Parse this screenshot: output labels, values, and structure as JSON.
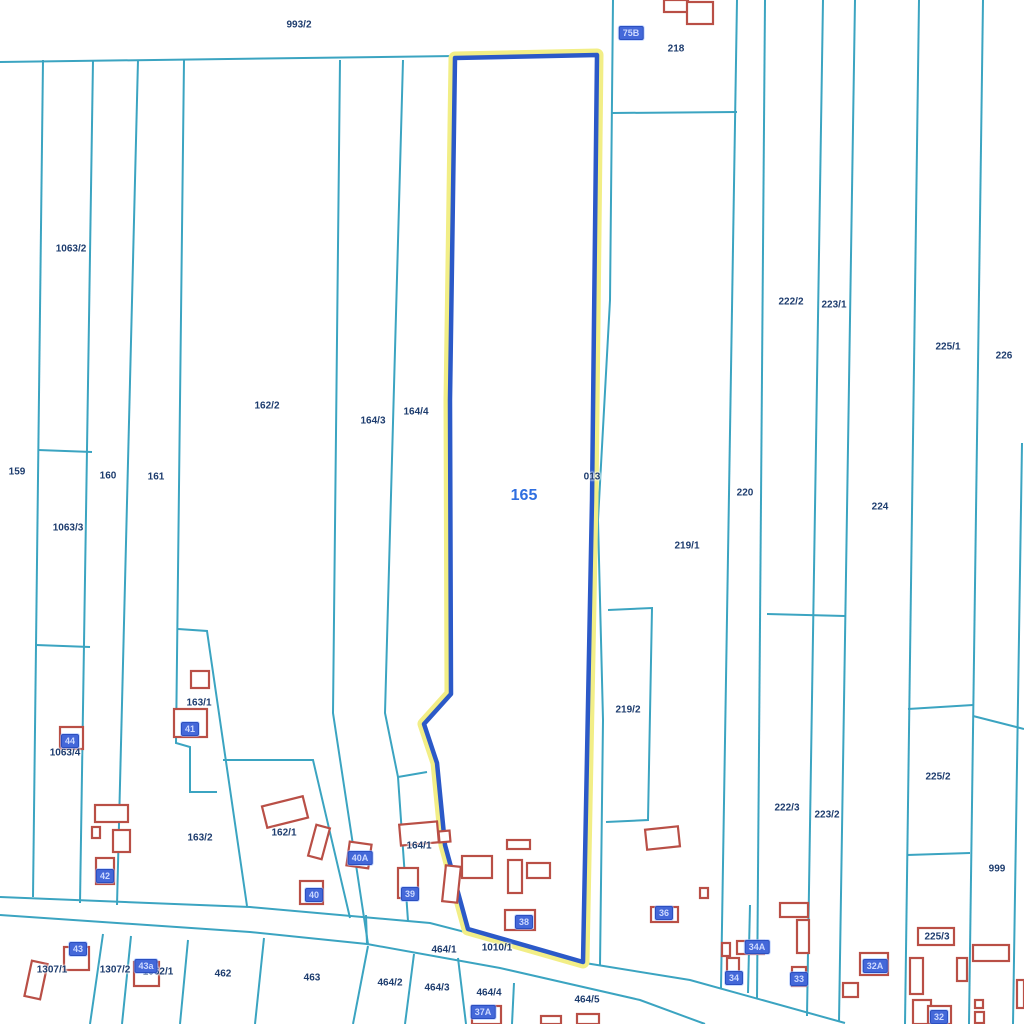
{
  "map": {
    "selected_parcel_id": "165",
    "colors": {
      "boundary_line": "#3BA4C1",
      "parcel_text": "#1d3c6e",
      "selected_text": "#2f6fe0",
      "building_stroke": "#b94f46",
      "building_label_bg": "#4468d9",
      "building_label_text": "#cdd9ff",
      "highlight_stroke": "#2b59c8",
      "highlight_halo": "#f2ee86"
    },
    "highlight_polygon": "455,58 597,55 592,500 583,962 468,929 445,845 437,763 424,724 451,694 450,400",
    "boundary_lines": [
      "0,62 455,56",
      "43,60 33,897",
      "93,60 80,903",
      "138,60 117,905",
      "184,60 176,743 190,747 190,792 217,792",
      "38,450 92,452",
      "36,645 90,647",
      "340,60 333,713 368,944",
      "403,60 385,713 398,777 408,921",
      "398,777 427,772",
      "178,629 207,631 247,906",
      "223,760 313,760 350,918",
      "0,897 250,907 430,923 585,963 690,980 845,1023",
      "0,915 250,932 367,944 500,968 640,1000 705,1024",
      "366,915 367,944",
      "613,0 610,300 598,520 603,720 600,966",
      "612,113 737,112",
      "737,0 721,988",
      "765,0 757,999",
      "750,905 748,993",
      "823,0 807,1016",
      "855,0 839,1022",
      "919,0 905,1024",
      "983,0 969,1024",
      "1022,443 1013,1024",
      "767,614 845,616",
      "908,709 973,705",
      "973,716 1024,729",
      "907,855 970,853",
      "608,610 652,608 648,820 606,822",
      "103,934 90,1024",
      "131,936 122,1024",
      "188,940 180,1024",
      "264,938 255,1024",
      "368,946 353,1024",
      "414,954 405,1024",
      "458,958 466,1024",
      "514,983 512,1024"
    ],
    "parcel_labels": [
      {
        "text": "993/2",
        "x": 299,
        "y": 25
      },
      {
        "text": "218",
        "x": 676,
        "y": 49
      },
      {
        "text": "1063/2",
        "x": 71,
        "y": 249
      },
      {
        "text": "222/2",
        "x": 791,
        "y": 302
      },
      {
        "text": "223/1",
        "x": 834,
        "y": 305
      },
      {
        "text": "225/1",
        "x": 948,
        "y": 347
      },
      {
        "text": "226",
        "x": 1004,
        "y": 356
      },
      {
        "text": "162/2",
        "x": 267,
        "y": 406
      },
      {
        "text": "164/4",
        "x": 416,
        "y": 412
      },
      {
        "text": "164/3",
        "x": 373,
        "y": 421
      },
      {
        "text": "159",
        "x": 17,
        "y": 472
      },
      {
        "text": "160",
        "x": 108,
        "y": 476
      },
      {
        "text": "161",
        "x": 156,
        "y": 477
      },
      {
        "text": "013",
        "x": 592,
        "y": 477
      },
      {
        "text": "220",
        "x": 745,
        "y": 493
      },
      {
        "text": "224",
        "x": 880,
        "y": 507
      },
      {
        "text": "1063/3",
        "x": 68,
        "y": 528
      },
      {
        "text": "219/1",
        "x": 687,
        "y": 546
      },
      {
        "text": "163/1",
        "x": 199,
        "y": 703
      },
      {
        "text": "219/2",
        "x": 628,
        "y": 710
      },
      {
        "text": "1063/4",
        "x": 65,
        "y": 753
      },
      {
        "text": "225/2",
        "x": 938,
        "y": 777
      },
      {
        "text": "222/3",
        "x": 787,
        "y": 808
      },
      {
        "text": "223/2",
        "x": 827,
        "y": 815
      },
      {
        "text": "162/1",
        "x": 284,
        "y": 833
      },
      {
        "text": "163/2",
        "x": 200,
        "y": 838
      },
      {
        "text": "164/1",
        "x": 419,
        "y": 846
      },
      {
        "text": "999",
        "x": 997,
        "y": 869
      },
      {
        "text": "225/3",
        "x": 937,
        "y": 937
      },
      {
        "text": "464/1",
        "x": 444,
        "y": 950
      },
      {
        "text": "1010/1",
        "x": 497,
        "y": 948
      },
      {
        "text": "1307/1",
        "x": 52,
        "y": 970
      },
      {
        "text": "1307/2",
        "x": 115,
        "y": 970
      },
      {
        "text": "1062/1",
        "x": 158,
        "y": 972
      },
      {
        "text": "462",
        "x": 223,
        "y": 974
      },
      {
        "text": "463",
        "x": 312,
        "y": 978
      },
      {
        "text": "464/2",
        "x": 390,
        "y": 983
      },
      {
        "text": "464/3",
        "x": 437,
        "y": 988
      },
      {
        "text": "464/4",
        "x": 489,
        "y": 993
      },
      {
        "text": "464/5",
        "x": 587,
        "y": 1000
      }
    ],
    "selected_label": {
      "text": "165",
      "x": 524,
      "y": 496
    },
    "building_labels": [
      {
        "text": "75B",
        "x": 631,
        "y": 33
      },
      {
        "text": "41",
        "x": 190,
        "y": 729
      },
      {
        "text": "44",
        "x": 70,
        "y": 741
      },
      {
        "text": "40A",
        "x": 360,
        "y": 858
      },
      {
        "text": "42",
        "x": 105,
        "y": 876
      },
      {
        "text": "40",
        "x": 314,
        "y": 895
      },
      {
        "text": "39",
        "x": 410,
        "y": 894
      },
      {
        "text": "36",
        "x": 664,
        "y": 913
      },
      {
        "text": "38",
        "x": 524,
        "y": 922
      },
      {
        "text": "34A",
        "x": 757,
        "y": 947
      },
      {
        "text": "43",
        "x": 78,
        "y": 949
      },
      {
        "text": "43a",
        "x": 146,
        "y": 966
      },
      {
        "text": "32A",
        "x": 875,
        "y": 966
      },
      {
        "text": "34",
        "x": 734,
        "y": 978
      },
      {
        "text": "33",
        "x": 799,
        "y": 979
      },
      {
        "text": "37A",
        "x": 483,
        "y": 1012
      },
      {
        "text": "32",
        "x": 939,
        "y": 1017
      }
    ],
    "buildings": [
      {
        "x": 664,
        "y": 0,
        "w": 24,
        "h": 12,
        "rot": 0
      },
      {
        "x": 687,
        "y": 2,
        "w": 26,
        "h": 22,
        "rot": 0
      },
      {
        "x": 191,
        "y": 671,
        "w": 18,
        "h": 17,
        "rot": 0
      },
      {
        "x": 174,
        "y": 709,
        "w": 33,
        "h": 28,
        "rot": 0
      },
      {
        "x": 60,
        "y": 727,
        "w": 23,
        "h": 22,
        "rot": 0
      },
      {
        "x": 95,
        "y": 805,
        "w": 33,
        "h": 17,
        "rot": 0
      },
      {
        "x": 92,
        "y": 827,
        "w": 8,
        "h": 11,
        "rot": 0
      },
      {
        "x": 113,
        "y": 830,
        "w": 17,
        "h": 22,
        "rot": 0
      },
      {
        "x": 96,
        "y": 858,
        "w": 18,
        "h": 26,
        "rot": 0
      },
      {
        "x": 264,
        "y": 801,
        "w": 42,
        "h": 22,
        "rot": -14
      },
      {
        "x": 312,
        "y": 826,
        "w": 14,
        "h": 32,
        "rot": 15
      },
      {
        "x": 348,
        "y": 843,
        "w": 22,
        "h": 24,
        "rot": 8
      },
      {
        "x": 300,
        "y": 881,
        "w": 23,
        "h": 23,
        "rot": 0
      },
      {
        "x": 400,
        "y": 823,
        "w": 38,
        "h": 21,
        "rot": -5
      },
      {
        "x": 439,
        "y": 831,
        "w": 11,
        "h": 11,
        "rot": -5
      },
      {
        "x": 444,
        "y": 866,
        "w": 15,
        "h": 36,
        "rot": 6
      },
      {
        "x": 462,
        "y": 856,
        "w": 30,
        "h": 22,
        "rot": 0
      },
      {
        "x": 508,
        "y": 860,
        "w": 14,
        "h": 33,
        "rot": 0
      },
      {
        "x": 527,
        "y": 863,
        "w": 23,
        "h": 15,
        "rot": 0
      },
      {
        "x": 507,
        "y": 840,
        "w": 23,
        "h": 9,
        "rot": 0
      },
      {
        "x": 505,
        "y": 910,
        "w": 30,
        "h": 20,
        "rot": 0
      },
      {
        "x": 398,
        "y": 868,
        "w": 20,
        "h": 30,
        "rot": 0
      },
      {
        "x": 646,
        "y": 828,
        "w": 33,
        "h": 20,
        "rot": -6
      },
      {
        "x": 700,
        "y": 888,
        "w": 8,
        "h": 10,
        "rot": 0
      },
      {
        "x": 651,
        "y": 907,
        "w": 27,
        "h": 15,
        "rot": 0
      },
      {
        "x": 722,
        "y": 943,
        "w": 8,
        "h": 13,
        "rot": 0
      },
      {
        "x": 737,
        "y": 941,
        "w": 27,
        "h": 13,
        "rot": 0
      },
      {
        "x": 727,
        "y": 958,
        "w": 12,
        "h": 25,
        "rot": 0
      },
      {
        "x": 780,
        "y": 903,
        "w": 28,
        "h": 14,
        "rot": 0
      },
      {
        "x": 797,
        "y": 920,
        "w": 12,
        "h": 33,
        "rot": 0
      },
      {
        "x": 792,
        "y": 967,
        "w": 14,
        "h": 19,
        "rot": 0
      },
      {
        "x": 860,
        "y": 953,
        "w": 28,
        "h": 22,
        "rot": 0
      },
      {
        "x": 843,
        "y": 983,
        "w": 15,
        "h": 14,
        "rot": 0
      },
      {
        "x": 918,
        "y": 928,
        "w": 36,
        "h": 17,
        "rot": 0
      },
      {
        "x": 910,
        "y": 958,
        "w": 13,
        "h": 36,
        "rot": 0
      },
      {
        "x": 957,
        "y": 958,
        "w": 10,
        "h": 23,
        "rot": 0
      },
      {
        "x": 973,
        "y": 945,
        "w": 36,
        "h": 16,
        "rot": 0
      },
      {
        "x": 975,
        "y": 1000,
        "w": 8,
        "h": 8,
        "rot": 0
      },
      {
        "x": 975,
        "y": 1012,
        "w": 9,
        "h": 11,
        "rot": 0
      },
      {
        "x": 913,
        "y": 1000,
        "w": 18,
        "h": 24,
        "rot": 0
      },
      {
        "x": 928,
        "y": 1006,
        "w": 23,
        "h": 18,
        "rot": 0
      },
      {
        "x": 1017,
        "y": 980,
        "w": 7,
        "h": 28,
        "rot": 0
      },
      {
        "x": 28,
        "y": 962,
        "w": 16,
        "h": 36,
        "rot": 12
      },
      {
        "x": 64,
        "y": 947,
        "w": 25,
        "h": 23,
        "rot": 0
      },
      {
        "x": 134,
        "y": 962,
        "w": 25,
        "h": 24,
        "rot": 0
      },
      {
        "x": 472,
        "y": 1006,
        "w": 29,
        "h": 18,
        "rot": 0
      },
      {
        "x": 541,
        "y": 1016,
        "w": 20,
        "h": 8,
        "rot": 0
      },
      {
        "x": 577,
        "y": 1014,
        "w": 22,
        "h": 10,
        "rot": 0
      }
    ]
  }
}
